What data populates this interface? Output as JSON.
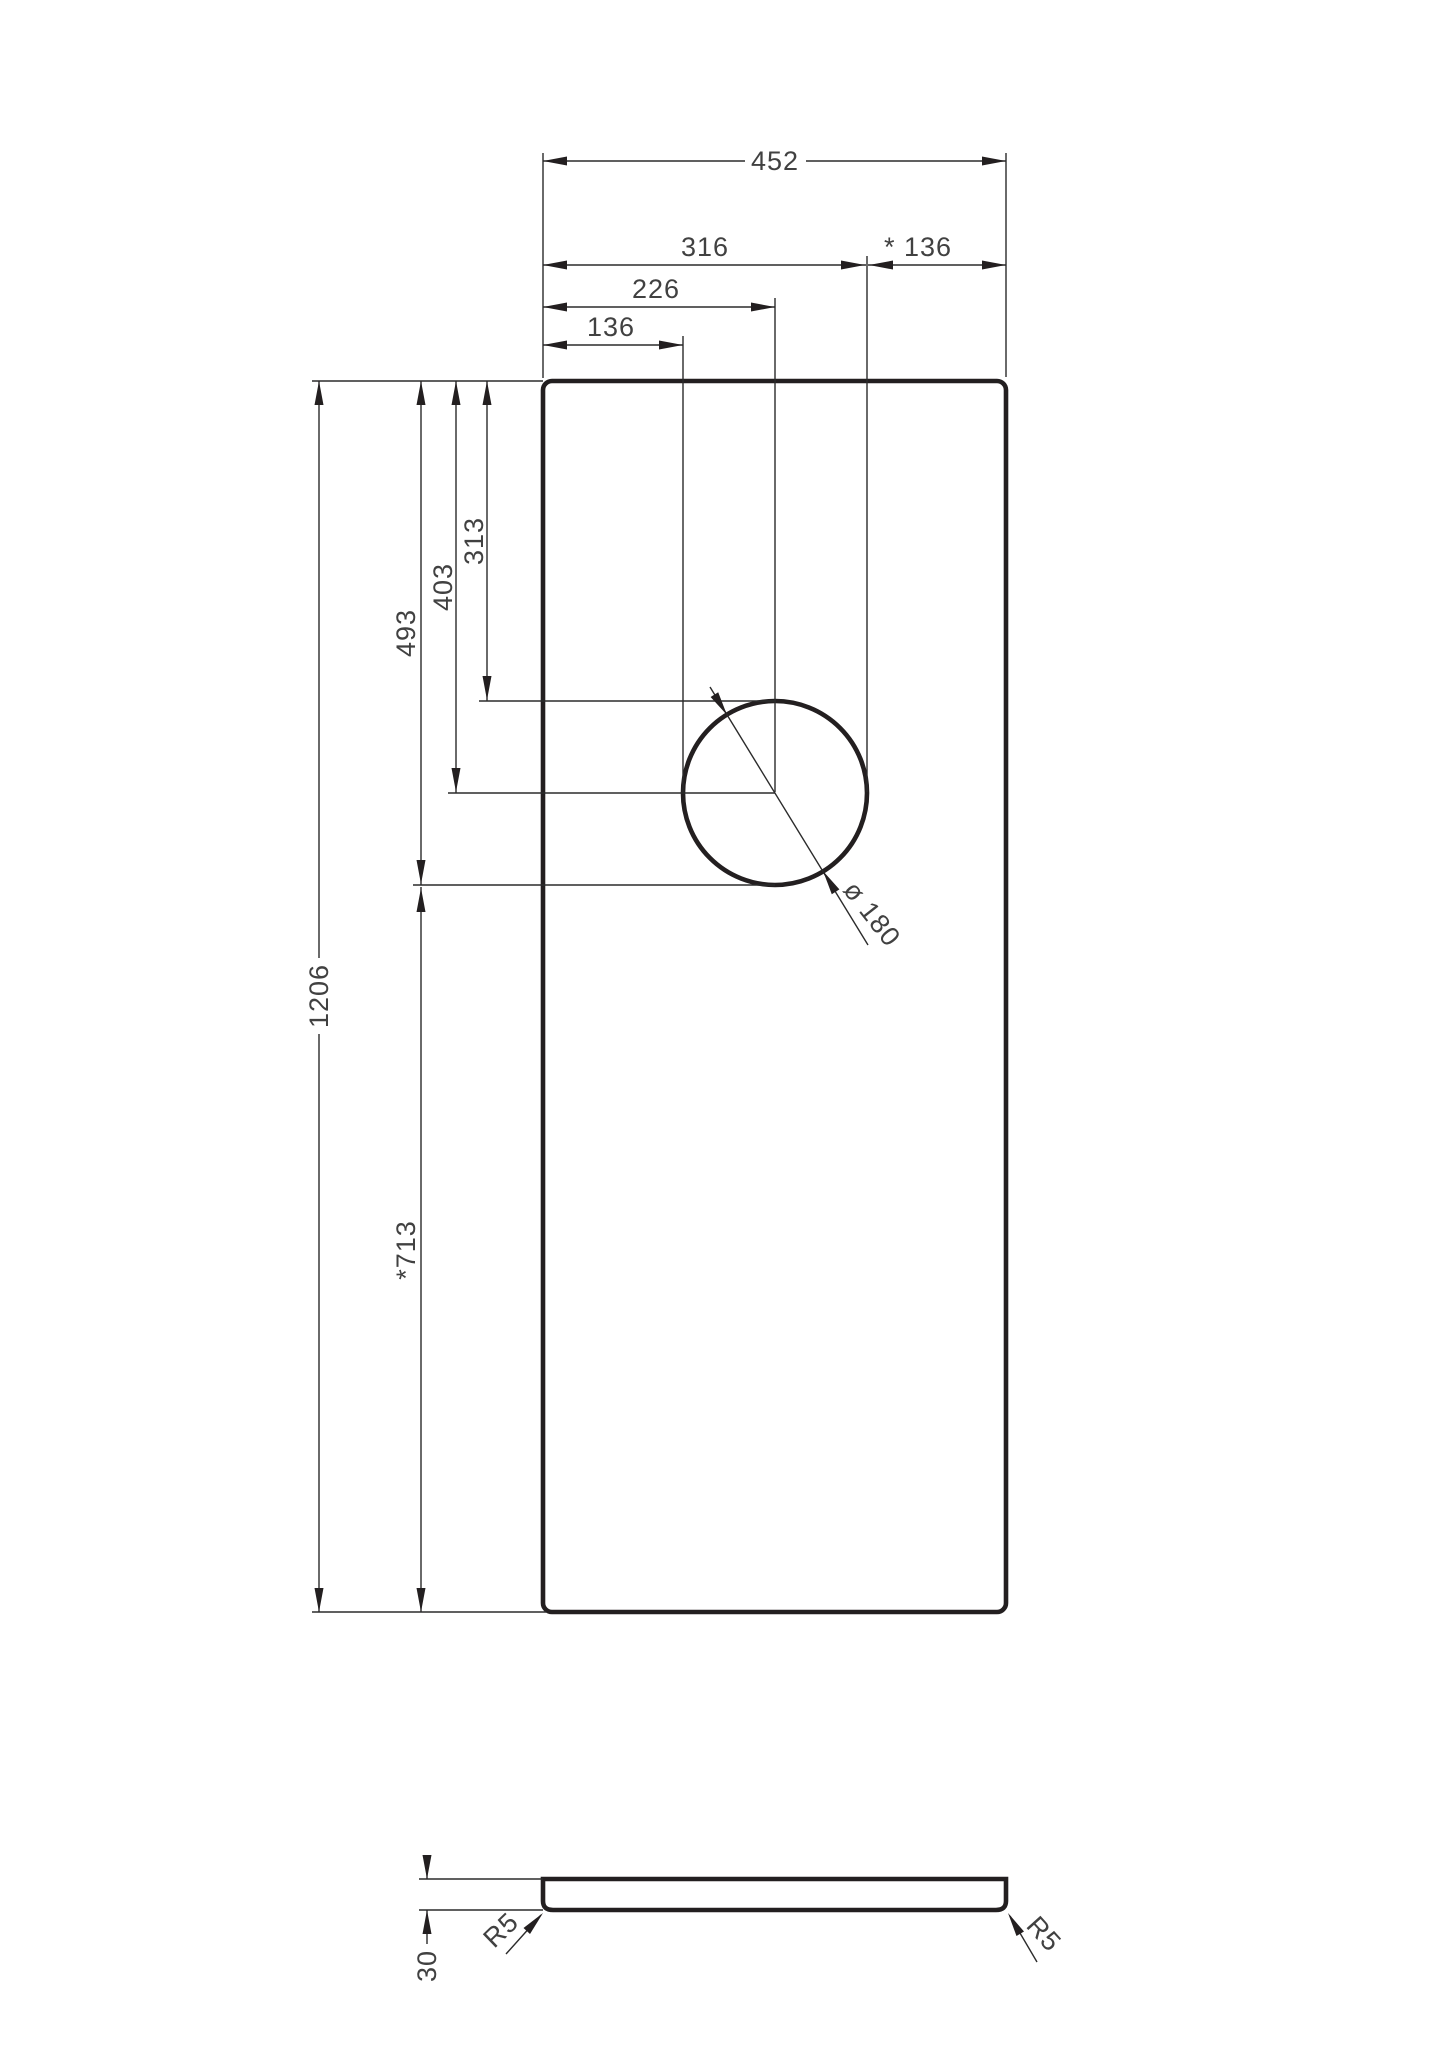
{
  "drawing": {
    "background_color": "#ffffff",
    "line_color": "#231f20",
    "text_color": "#414141",
    "plan": {
      "dims": {
        "overall_width": "452",
        "left_to_hole_right_edge": "316",
        "hole_right_edge_to_panel_right": "* 136",
        "left_to_hole_center": "226",
        "left_to_hole_left_edge": "136",
        "overall_length": "1206",
        "top_to_hole_bottom": "493",
        "top_to_hole_center": "403",
        "top_to_hole_top": "313",
        "hole_bottom_to_panel_bottom": "*713",
        "hole_diameter": "ø 180"
      }
    },
    "section": {
      "dims": {
        "thickness": "30",
        "corner_radius_left": "R5",
        "corner_radius_right": "R5"
      }
    }
  }
}
